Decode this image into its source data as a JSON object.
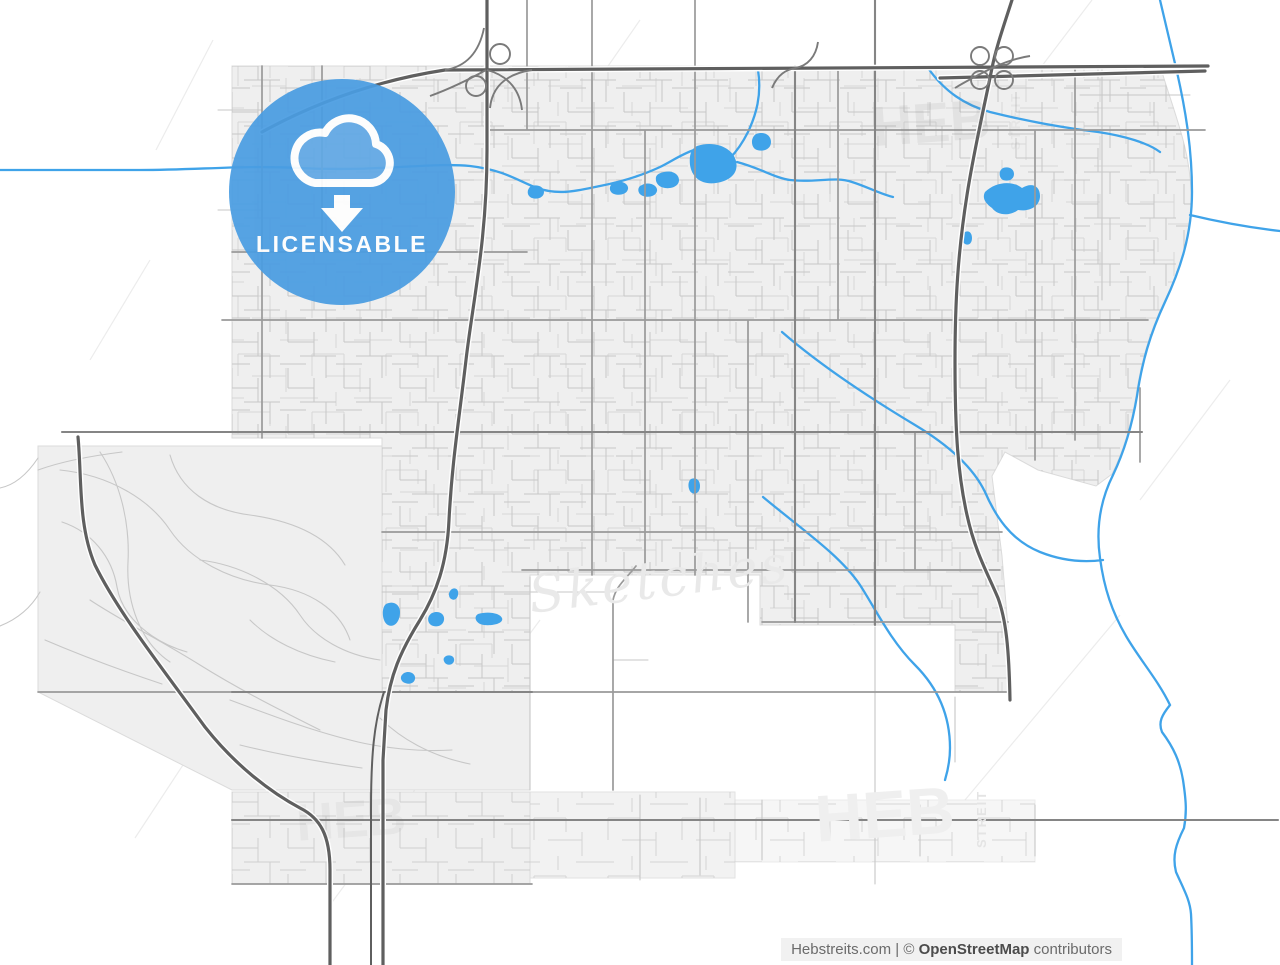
{
  "page": {
    "width": 1280,
    "height": 965
  },
  "badge": {
    "label": "LICENSABLE",
    "icon": "cloud-download-icon"
  },
  "watermarks": {
    "script": "Sketches",
    "brand": "HEB",
    "brand_vertical": "STREIT"
  },
  "attribution": {
    "site": "Hebstreits.com",
    "separator": "|",
    "copyright_symbol": "©",
    "map_credit": "OpenStreetMap",
    "credit_suffix": "contributors"
  },
  "colors": {
    "badge-blue": "#4A9DE2",
    "water": "#3FA3E9",
    "urban-fill": "#EFEFEF",
    "urban-edge": "#DBDBDB",
    "street": "#C7C7C7",
    "road": "#9A9A9A",
    "highway": "#5F5F5F",
    "attribution-bg": "#F1F1F1",
    "attribution-text": "#6B6B6B"
  }
}
